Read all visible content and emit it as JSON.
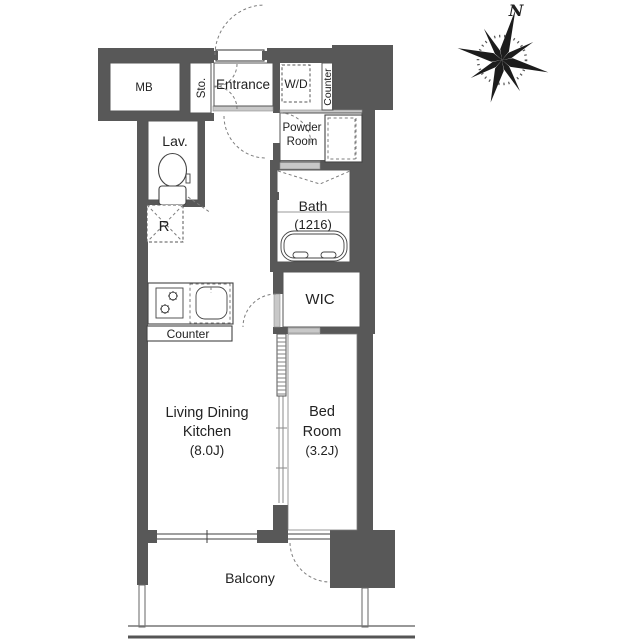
{
  "title": "Apartment floor plan (1K layout)",
  "labels": {
    "mb": "MB",
    "sto": "Sto.",
    "entrance": "Entrance",
    "wd": "W/D",
    "counter_upper": "Counter",
    "powder_1": "Powder",
    "powder_2": "Room",
    "lav": "Lav.",
    "bath": "Bath",
    "bath_size": "(1216)",
    "fridge": "R",
    "wic": "WIC",
    "kitchen_counter": "Counter",
    "ldk_1": "Living Dining",
    "ldk_2": "Kitchen",
    "ldk_size": "(8.0J)",
    "bed_1": "Bed",
    "bed_2": "Room",
    "bed_size": "(3.2J)",
    "balcony": "Balcony"
  },
  "compass": {
    "north": "N"
  },
  "colors": {
    "wall": "#585858",
    "line": "#444444",
    "text": "#222222",
    "dashed": "#7d7d7d",
    "light_wall": "#c8c8c8"
  }
}
